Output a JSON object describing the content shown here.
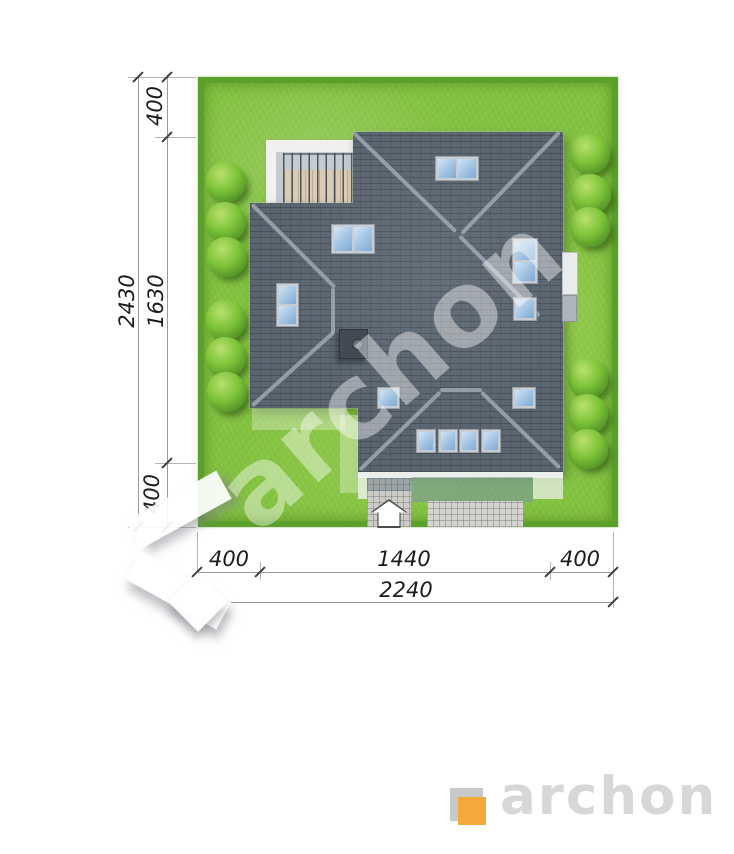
{
  "document": {
    "type": "architectural-site-plan-top-view",
    "units": "centimeters"
  },
  "dimensions": {
    "left": {
      "top_setback": "400",
      "plot_height": "2430",
      "house_depth": "1630",
      "bottom_setback": "400"
    },
    "bottom": {
      "left_setback": "400",
      "house_width": "1440",
      "right_setback": "400",
      "plot_width": "2240"
    }
  },
  "watermark": {
    "text": "archon"
  },
  "logo": {
    "wordmark": "archon"
  },
  "palette": {
    "lawn_green": "#83C23F",
    "hedge_green": "#5BA02B",
    "roof_slate": "#5A6570",
    "skylight_blue": "#8FB6DC",
    "paving_gray": "#CBCCC7",
    "logo_orange": "#F4A93C",
    "logo_gray": "#D5D7D9"
  },
  "site": {
    "bushes_left_count": 6,
    "bushes_right_count": 6,
    "skylight_group_count": 11,
    "skylight_pane_count": 15,
    "has_chimney": true,
    "has_terrace_pergola": true,
    "has_entrance_arrow": true
  }
}
